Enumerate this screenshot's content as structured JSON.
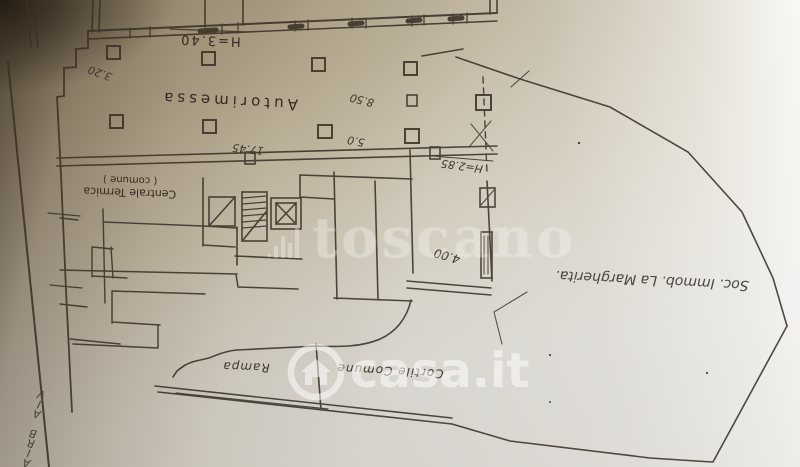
{
  "watermarks": {
    "toscano": "toscano",
    "casa_it": "casa.it"
  },
  "plan": {
    "rooms": {
      "garage": "Autorimessa",
      "boiler": "Centrale Termica",
      "boiler_note": "( comune )",
      "ramp": "Rampa",
      "courtyard": "Cortile Comune"
    },
    "heights": {
      "garage": "H=3.40",
      "right_area": "H=2.85"
    },
    "dimensions": {
      "left": "3.20",
      "mid": "17.45",
      "right_upper": "8.50",
      "right_lower": "5.0",
      "gate": "4.00"
    },
    "street_name": "VIA BRIA",
    "owner_note": "Soc. Immob. La Margherita."
  },
  "colors": {
    "ink": "#3a3127",
    "handwriting": "#3f372c",
    "paper_shadow": "#6b5c45",
    "paper_mid": "#bfb49e",
    "paper_light": "#d7d4ce",
    "watermark_white": "#ffffff"
  }
}
